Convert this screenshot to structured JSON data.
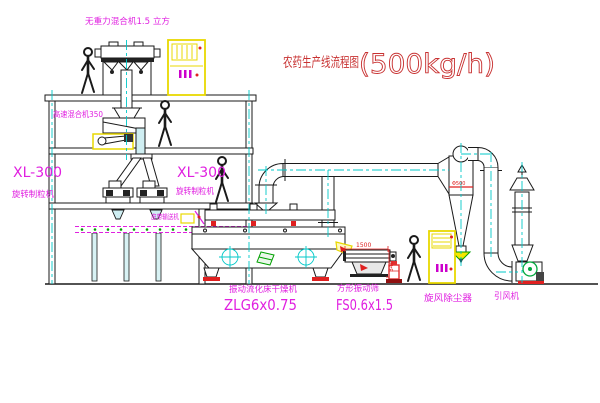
{
  "title": {
    "text": "农药生产线流程图",
    "capacity": "(500kg/h)"
  },
  "labels": {
    "gravity_mixer": "无重力混合机1.5 立方",
    "high_speed_mixer": "高速混合机350",
    "granulator_model": "XL-300",
    "granulator": "旋转制粒机",
    "belt_conveyor": "皮带输送机",
    "fluid_bed_dryer": "振动流化床干燥机",
    "fluid_bed_dryer_model": "ZLG6x0.75",
    "vibrating_sieve": "方形振动筛",
    "vibrating_sieve_model": "FS0.6x1.5",
    "cyclone_dust_collector": "旋风除尘器",
    "induced_draft_fan": "引风机"
  },
  "dims": {
    "sieve_length": "1500",
    "sieve_height": "340",
    "cyclone_note": "Φ500"
  },
  "colors": {
    "label_magenta": "#e020e0",
    "title_red": "#c83232",
    "centerline_cyan": "#00c8c8",
    "cabinet_yellow": "#e8d800",
    "accent_red": "#e02020",
    "accent_green": "#00a000",
    "line_black": "#1a1a1a"
  }
}
